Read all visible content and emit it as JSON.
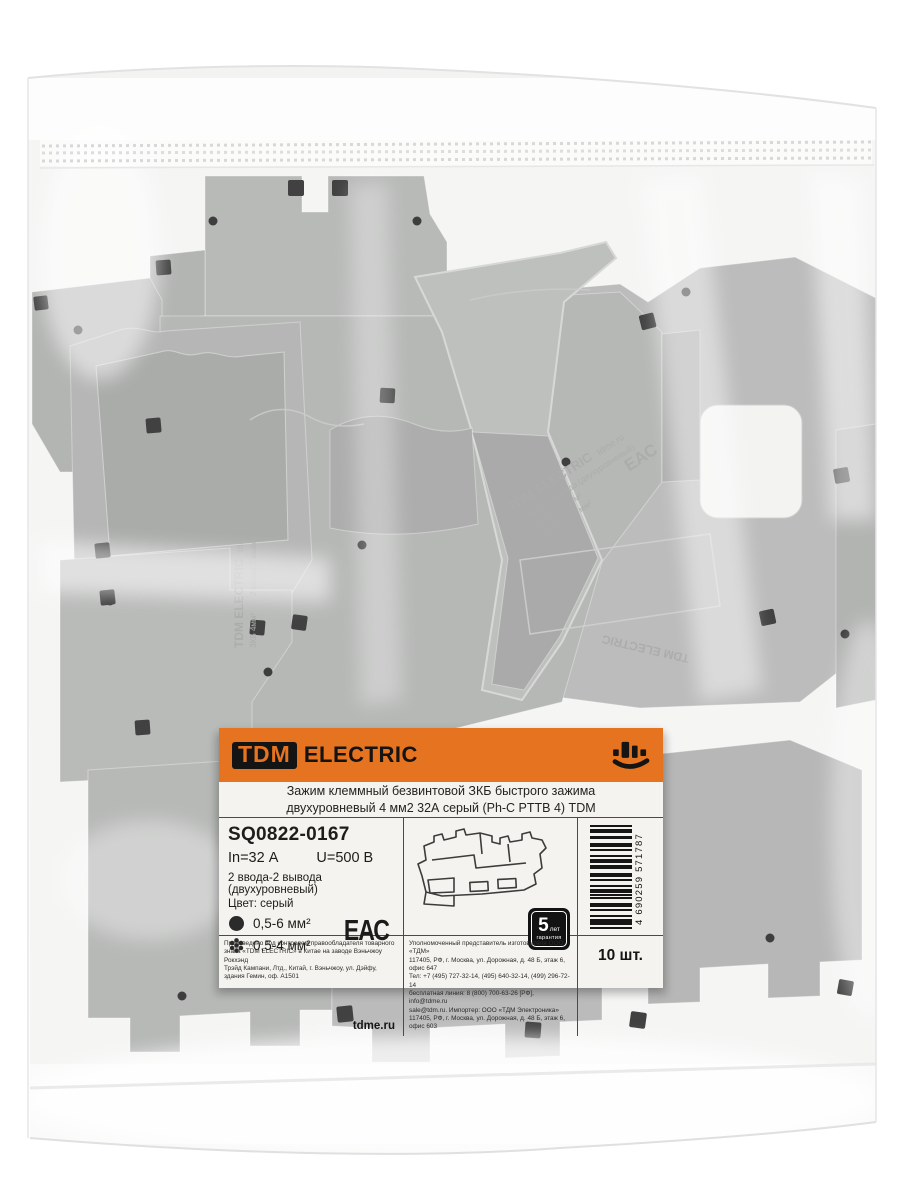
{
  "colors": {
    "accent_orange": "#e5731f",
    "plastic_gray": "#a9aba9",
    "label_bg": "#f5f3ef",
    "hole_black": "#181818"
  },
  "label": {
    "brand": {
      "box": "TDM",
      "rest": "ELECTRIC"
    },
    "title_line1": "Зажим клеммный безвинтовой ЗКБ быстрого зажима",
    "title_line2": "двухуровневый 4 мм2 32А серый (Ph-C PTTB 4) TDM",
    "sku": "SQ0822-0167",
    "current": "In=32 А",
    "voltage": "U=500 В",
    "config": "2 ввода-2 вывода (двухуровневый)",
    "color_row": "Цвет: серый",
    "wire_solid": "0,5-6 мм²",
    "wire_stranded": "0,5-4 мм²",
    "eac_mark": "ЕАС",
    "warranty": {
      "years": "5",
      "unit": "лет",
      "word": "гарантия"
    },
    "barcode_digits": "4 690259 571787",
    "qty": "10 шт.",
    "site": "tdme.ru",
    "made_in": "Произведено под контролем правообладателя товарного\nзнака «TDM ELECTRIC» в Китае на заводе Вэньчжоу Рокхэнд\nТрэйд Кампани, Лтд., Китай, г. Вэньчжоу, ул. Дэйфу,\nздания Гемин, оф. А1501",
    "importer": "Уполномоченный представитель изготовителя ООО «ТДМ»\n117405, РФ, г. Москва, ул. Дорожная, д. 48 Б, этаж 6, офис 647\nТел: +7 (495) 727-32-14, (495) 640-32-14, (499) 296-72-14\nбесплатная линия: 8 (800) 700-63-26 [РФ], info@tdme.ru\nsale@tdm.ru. Импортер: ООО «ТДМ Электроника»\n117405, РФ, г. Москва, ул. Дорожная, д. 48 Б, этаж 6, офис 603"
  },
  "embossed": {
    "brand": "TDM ELECTRIC",
    "site": "tdme.ru",
    "product": "ЗКБ 4мм²",
    "config": "2 ввода-2 вывода (двухуровневый)",
    "current": "In=32 A   0,5-6 мм²",
    "voltage": "U=500 B   0,5-4 мм²",
    "eac": "ЕАС"
  }
}
